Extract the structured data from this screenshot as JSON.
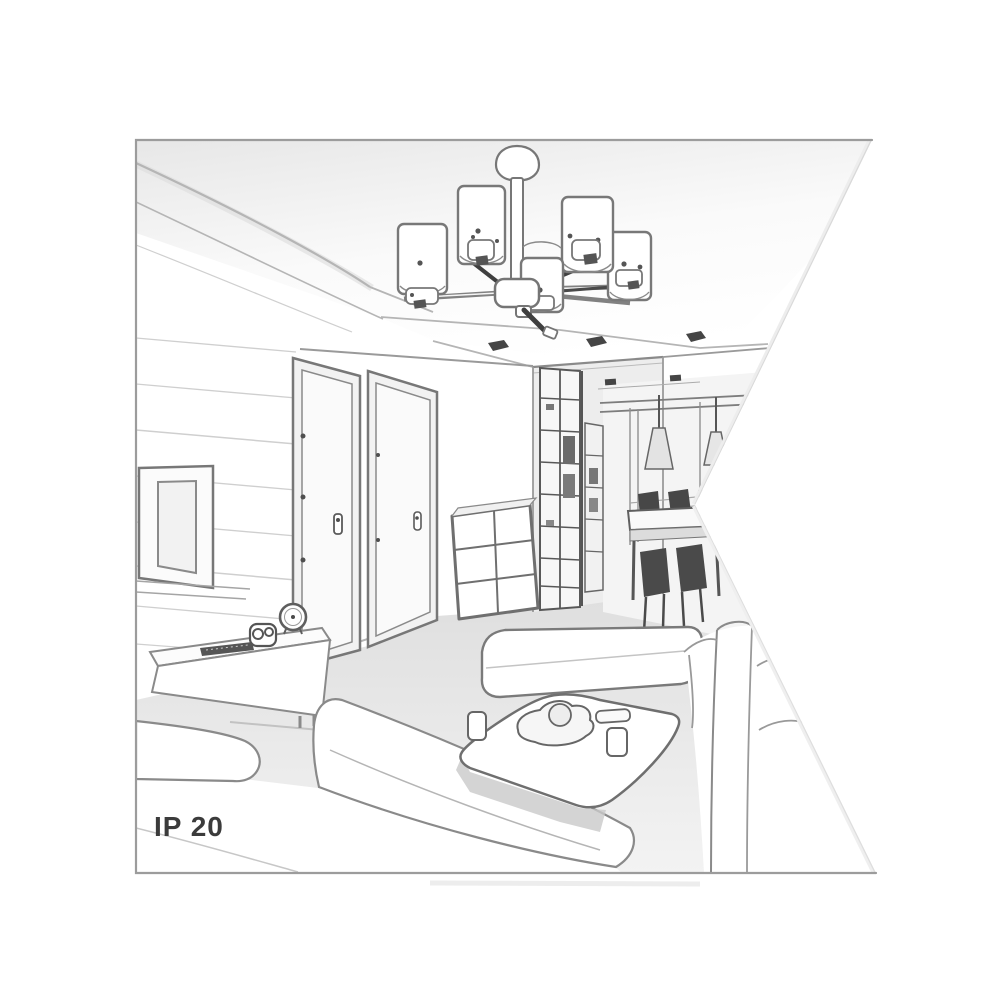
{
  "label": {
    "ip_rating": "IP 20"
  },
  "colors": {
    "background": "#ffffff",
    "border": "#9c9c9c",
    "line": "#7c7c7c",
    "dark": "#454545",
    "shade_fill": "#ffffff",
    "wall": "#f4f4f4",
    "floor": "#e5e5e5",
    "text": "#3b3b3b"
  },
  "scene": {
    "type": "grayscale perspective line drawing of a living room interior",
    "objects": [
      "ceiling-chandelier-with-cylinder-shades",
      "recessed-ceiling-spotlights",
      "paneled-tv-wall",
      "flat-screen-tv",
      "tv-sideboard",
      "remote-control",
      "camera",
      "alarm-clock",
      "interior-door-left",
      "interior-door-right",
      "drawer-chest",
      "hallway-wardrobe",
      "cone-pendant-lights",
      "dining-table-with-chairs",
      "window",
      "bench-seat",
      "coffee-table-with-tray-and-cups",
      "corner-sofa-left",
      "sofa-right"
    ]
  }
}
